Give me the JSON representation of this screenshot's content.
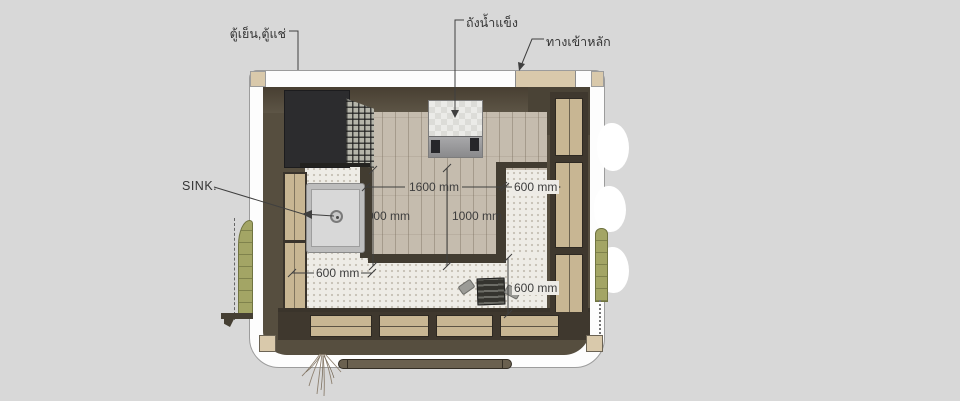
{
  "scene": {
    "labels": {
      "fridge": "ตู้เย็น,ตู้แช่",
      "ice_tank": "ถังน้ำแข็ง",
      "main_entrance": "ทางเข้าหลัก",
      "sink": "SINK."
    },
    "dims": {
      "floor_width": "1600 mm",
      "right_counter_depth": "600 mm",
      "left_aisle_depth": "1000 mm",
      "aisle_depth": "1000 mm",
      "sink_counter_width": "600 mm",
      "front_counter_depth": "600 mm"
    },
    "colors": {
      "background": "#d8d8d8",
      "wall_dark": "#564e3f",
      "wood_floor": "#c5bcae",
      "counter_terrazzo": "#eeece6",
      "entrance_tan": "#d9c9ab",
      "window_wood": "#c8b693",
      "plant_green": "#a3a565",
      "annotation": "#3f3f3f"
    }
  }
}
